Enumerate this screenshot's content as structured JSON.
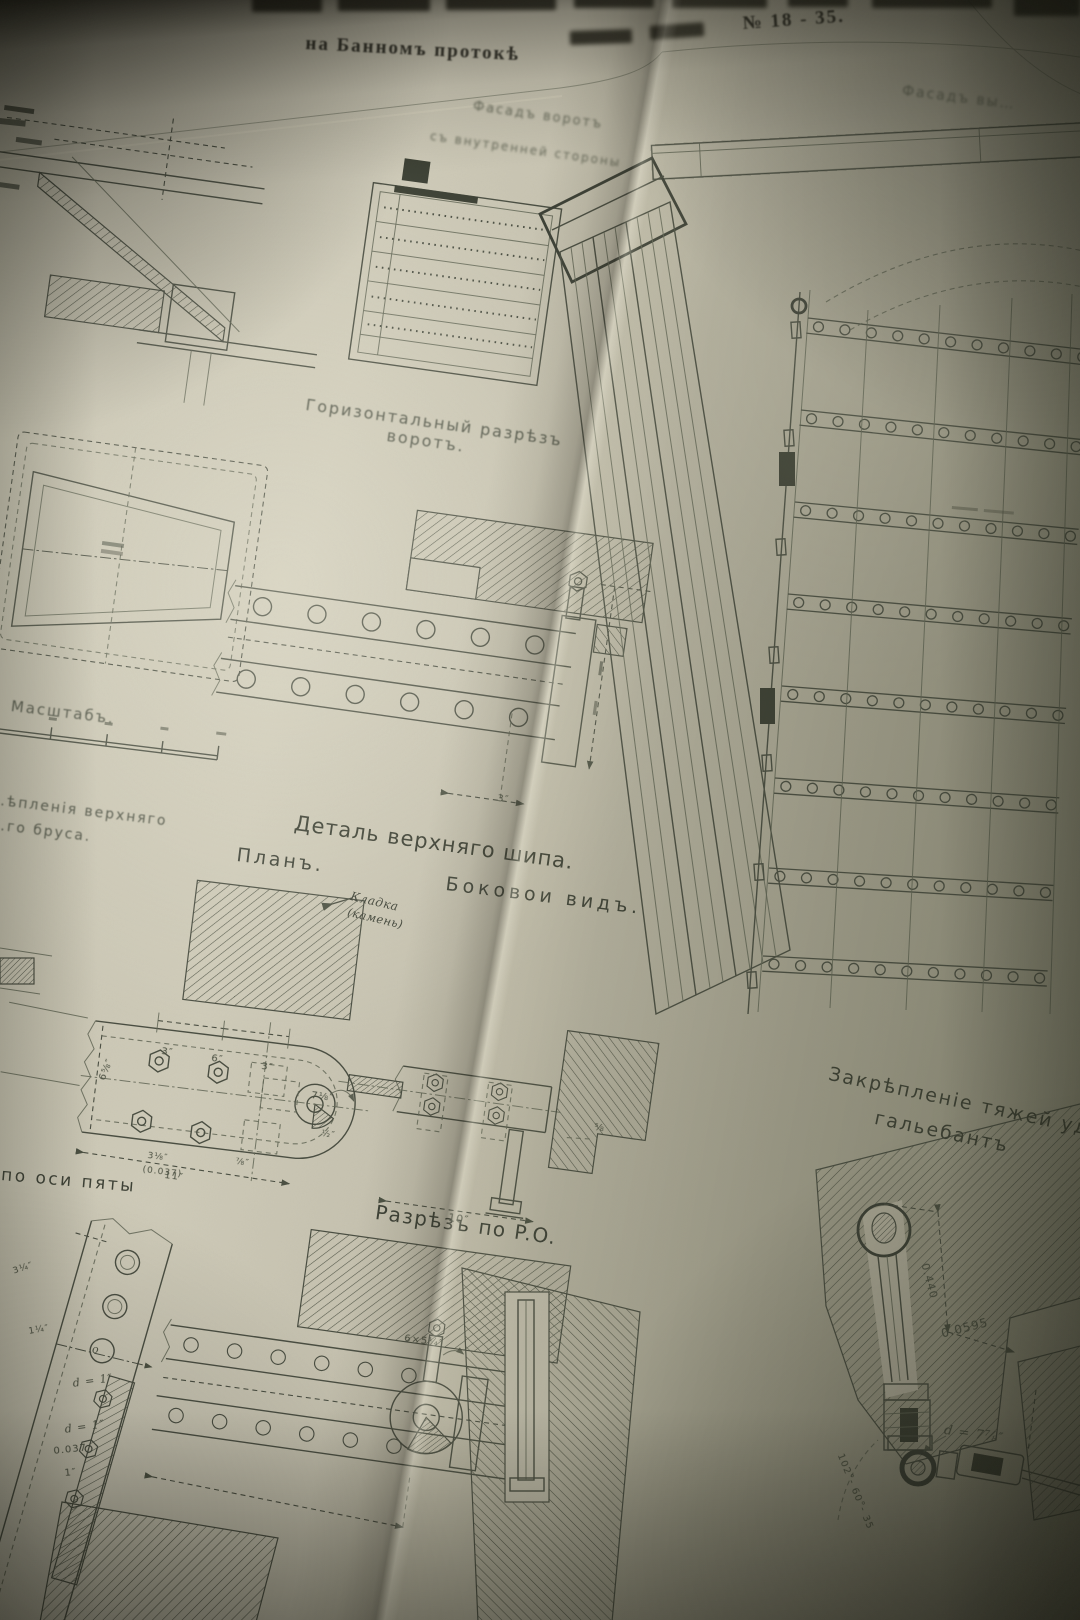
{
  "palette": {
    "paper": "#c9c5b3",
    "ink": "#42463a"
  },
  "header": {
    "title_fragment": "на Банномъ протокѣ",
    "title_number": "№ 18 - 35."
  },
  "left_page": {
    "labels": {
      "facade_inner_1": "Фасадъ воротъ",
      "facade_inner_2": "съ внутренней стороны",
      "horizontal_section_1": "Горизонтальный разрѣзъ",
      "horizontal_section_2": "воротъ.",
      "scale": "Масштабъ.",
      "fastening_1": "…ѣпленія верхняго",
      "fastening_2": "…го бруса.",
      "detail_top_tenon": "Деталь верхняго шипа.",
      "plan": "Планъ.",
      "side_view": "Боковои видъ.",
      "masonry_note_1": "Кладка",
      "masonry_note_2": "(камень)",
      "section_po": "Разрѣзъ по P.O.",
      "axis_heel": "по оси пяты"
    },
    "dims": {
      "tenon_3": "3″",
      "plan_3a": "3″",
      "plan_6": "6″",
      "plan_3b": "3″",
      "plan_658": "6⅝″",
      "plan_718": "7⅛″",
      "plan_12": "½″",
      "plan_11": "11″",
      "plan_318": "3⅛″",
      "plan_0037": "(0.037)",
      "plan_78": "⅞″",
      "side_10": "10″",
      "side_58": "⅝",
      "flange_314": "3¼″",
      "flange_114": "1¼″",
      "flange_o": "o",
      "flange_d1a": "d = 1″",
      "flange_d1b": "d = 1″",
      "flange_0037": "0.037",
      "flange_1": "1″",
      "girder_654": "6×5¼″"
    }
  },
  "right_page": {
    "labels": {
      "facade_top": "Фасадъ вы…",
      "tie_1": "Закрѣпленіе тяжей уде…",
      "tie_2": "гальебантъ"
    },
    "dims": {
      "tie_0440": "0.440",
      "tie_00595": "0.0595",
      "tie_d78": "d = 7⅞″",
      "tie_angle": "102°- 60°- 35"
    }
  }
}
